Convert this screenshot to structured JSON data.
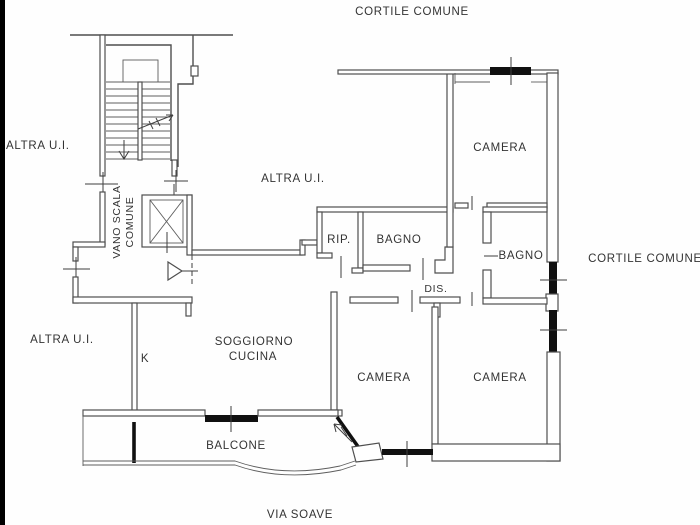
{
  "plan": {
    "title": "floor-plan",
    "labels": {
      "cortile_top": "CORTILE COMUNE",
      "cortile_right": "CORTILE COMUNE",
      "altra_ui_top": "ALTRA U.I.",
      "altra_ui_mid": "ALTRA U.I.",
      "altra_ui_bottom": "ALTRA U.I.",
      "vano_scala_line1": "VANO SCALA",
      "vano_scala_line2": "COMUNE",
      "rip": "RIP.",
      "bagno1": "BAGNO",
      "bagno2": "BAGNO",
      "camera_top": "CAMERA",
      "camera_mid": "CAMERA",
      "camera_right": "CAMERA",
      "dis": "DIS.",
      "soggiorno_line1": "SOGGIORNO",
      "soggiorno_line2": "CUCINA",
      "kitchen_k": "K",
      "balcone": "BALCONE",
      "via_soave": "VIA SOAVE"
    },
    "colors": {
      "wall": "#4f4f4f",
      "window": "#101010",
      "text": "#333333",
      "frame": "#000000",
      "background": "#fefefe"
    }
  }
}
